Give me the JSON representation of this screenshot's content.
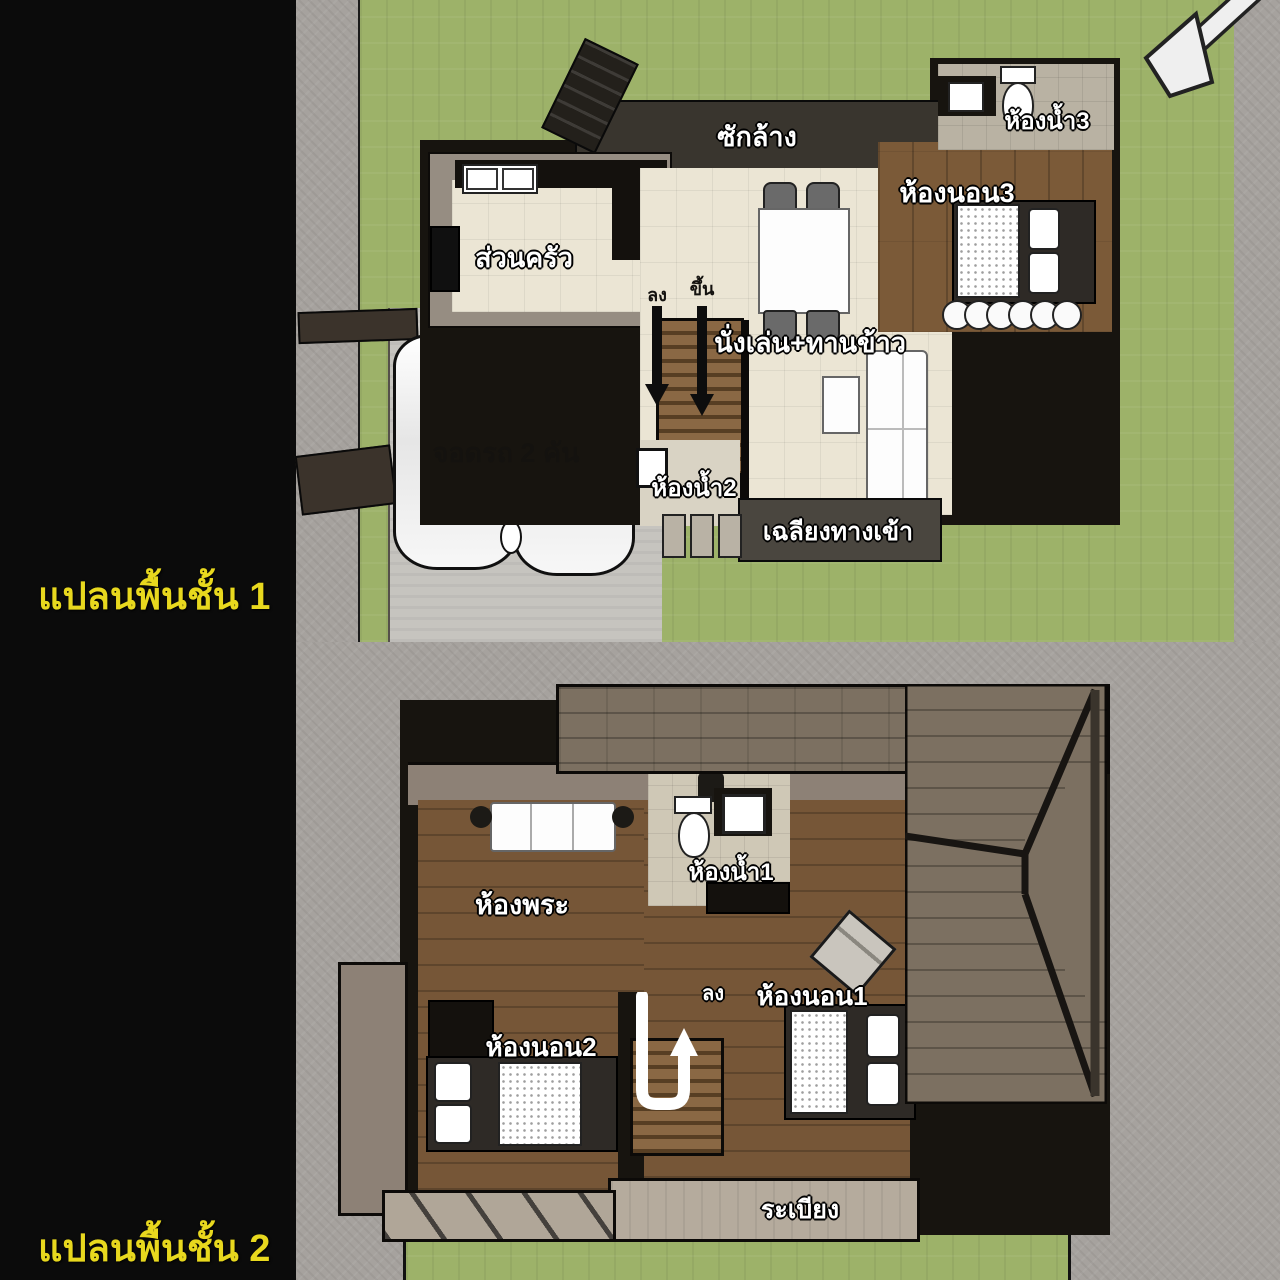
{
  "titles": {
    "plan1": "แปลนพื้นชั้น 1",
    "plan2": "แปลนพื้นชั้น 2"
  },
  "plan1": {
    "rooms": {
      "laundry": "ซักล้าง",
      "kitchen": "ส่วนครัว",
      "bathroom3": "ห้องน้ำ3",
      "bedroom3": "ห้องนอน3",
      "living_dining": "นั่งเล่น+ทานข้าว",
      "bathroom2": "ห้องน้ำ2",
      "entrance_porch": "เฉลียงทางเข้า",
      "parking": "จอดรถ 2 คัน",
      "stairs_down": "ลง",
      "stairs_up": "ขึ้น"
    }
  },
  "plan2": {
    "rooms": {
      "prayer_room": "ห้องพระ",
      "bathroom1": "ห้องน้ำ1",
      "bedroom1": "ห้องนอน1",
      "bedroom2": "ห้องนอน2",
      "stairs_down": "ลง",
      "balcony": "ระเบียง"
    }
  },
  "icons": {
    "north_arrow": "north-arrow",
    "stairs_down_arrow_1": "black-down-arrow",
    "stairs_up_arrow_1": "black-down-arrow",
    "stairs_u_turn_arrow_2": "white-u-turn-arrow"
  },
  "colors": {
    "background": "#0b0b0b",
    "lawn": "#9db269",
    "road": "#a6a29e",
    "driveway": "#c6c4bf",
    "floor_cream": "#ebe5d4",
    "wood_floor": "#7b5a38",
    "roof": "#7c7061",
    "wall_dark": "#17140f",
    "wall_taupe": "#8d8176",
    "balcony_floor": "#b5ab9d",
    "title_yellow": "#e8d81e",
    "label_white": "#ffffff",
    "label_dark": "#1a1a1a"
  }
}
